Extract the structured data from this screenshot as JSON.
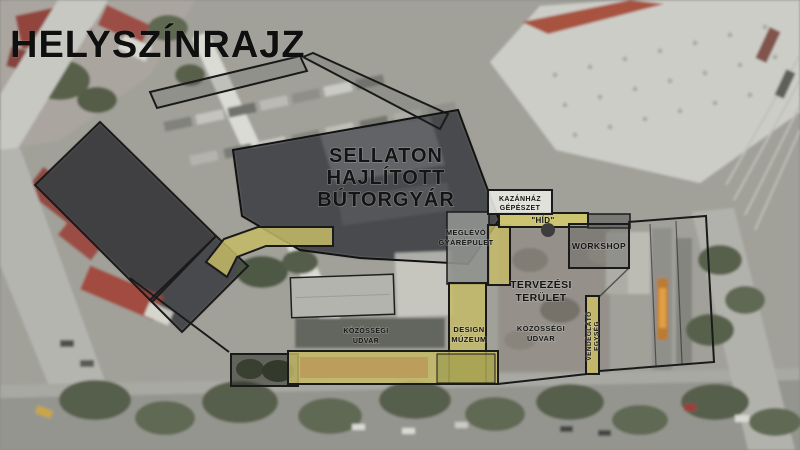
{
  "title": "HELYSZÍNRAJZ",
  "labels": {
    "factory": {
      "l1": "SELLATON",
      "l2": "HAJLÍTOTT",
      "l3": "BÚTORGYÁR"
    },
    "existing_building": {
      "l1": "MEGLÉVŐ",
      "l2": "GYÁRÉPÜLET"
    },
    "boiler_house": {
      "l1": "KAZÁNHÁZ",
      "l2": "GÉPÉSZET"
    },
    "bridge": "\"HÍD\"",
    "workshop": "WORKSHOP",
    "design_area": {
      "l1": "TERVEZÉSI",
      "l2": "TERÜLET"
    },
    "community_yard_west": {
      "l1": "KÖZÖSSÉGI",
      "l2": "UDVAR"
    },
    "design_museum": {
      "l1": "DESIGN",
      "l2": "MÚZEUM"
    },
    "community_yard_east": {
      "l1": "KÖZÖSSÉGI",
      "l2": "UDVAR"
    },
    "catering_unit": {
      "l1": "VENDÉGLÁTÓ",
      "l2": "EGYSÉG"
    }
  },
  "colors": {
    "highlight_yellow": "#c6bb67",
    "outline_black": "#1a1a1a",
    "label_text": "#141414"
  }
}
